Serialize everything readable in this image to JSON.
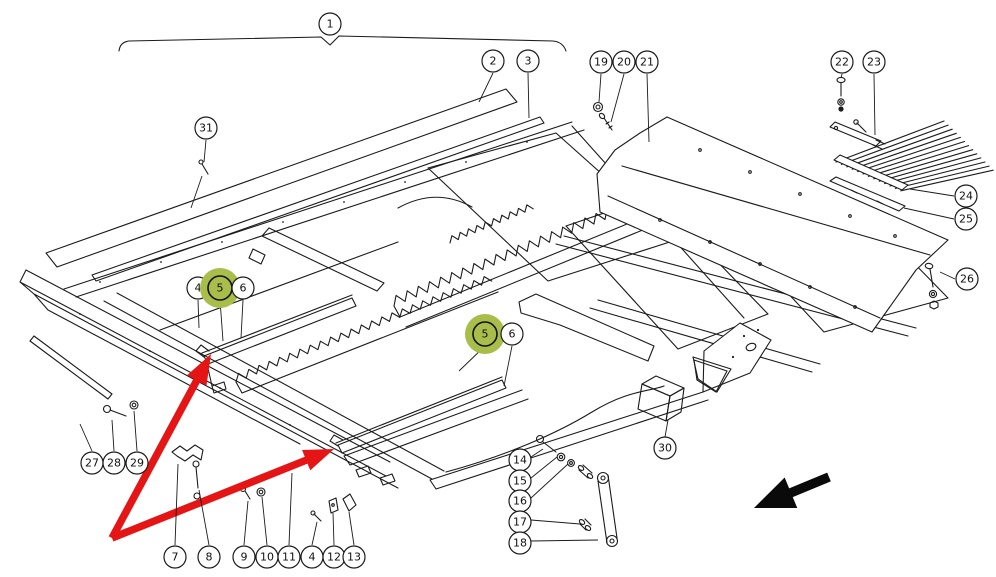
{
  "figure": {
    "title": "exploded-parts-diagram",
    "background_color": "#ffffff",
    "line_color": "#1b1b1b",
    "highlight_color": "#a9bd4a",
    "red_arrow_color": "#e51515",
    "black_arrow_color": "#0a0a0a",
    "callout_radius": 11,
    "highlight_halo_radius": 20
  },
  "assembly_bracket": {
    "label": "1",
    "x": 330,
    "y": 24
  },
  "callouts": [
    {
      "id": "1",
      "number": "1",
      "x": 330,
      "y": 24,
      "highlighted": false,
      "leaders": []
    },
    {
      "id": "2",
      "number": "2",
      "x": 493,
      "y": 61,
      "highlighted": false,
      "leaders": [
        [
          [
            493,
            73
          ],
          [
            479,
            102
          ]
        ]
      ]
    },
    {
      "id": "3",
      "number": "3",
      "x": 528,
      "y": 61,
      "highlighted": false,
      "leaders": [
        [
          [
            528,
            73
          ],
          [
            529,
            118
          ]
        ]
      ]
    },
    {
      "id": "31",
      "number": "31",
      "x": 206,
      "y": 128,
      "highlighted": false,
      "leaders": [
        [
          [
            206,
            140
          ],
          [
            204,
            162
          ]
        ],
        [
          [
            202,
            176
          ],
          [
            191,
            208
          ]
        ]
      ]
    },
    {
      "id": "19",
      "number": "19",
      "x": 601,
      "y": 62,
      "highlighted": false,
      "leaders": [
        [
          [
            601,
            74
          ],
          [
            599,
            102
          ]
        ]
      ]
    },
    {
      "id": "20",
      "number": "20",
      "x": 624,
      "y": 62,
      "highlighted": false,
      "leaders": [
        [
          [
            624,
            74
          ],
          [
            611,
            122
          ]
        ]
      ]
    },
    {
      "id": "21",
      "number": "21",
      "x": 647,
      "y": 62,
      "highlighted": false,
      "leaders": [
        [
          [
            647,
            74
          ],
          [
            649,
            142
          ]
        ]
      ]
    },
    {
      "id": "22",
      "number": "22",
      "x": 842,
      "y": 62,
      "highlighted": false,
      "leaders": [
        [
          [
            842,
            74
          ],
          [
            841,
            78
          ]
        ]
      ]
    },
    {
      "id": "23",
      "number": "23",
      "x": 874,
      "y": 62,
      "highlighted": false,
      "leaders": [
        [
          [
            874,
            74
          ],
          [
            875,
            135
          ]
        ]
      ]
    },
    {
      "id": "24",
      "number": "24",
      "x": 966,
      "y": 196,
      "highlighted": false,
      "leaders": [
        [
          [
            954,
            196
          ],
          [
            910,
            189
          ]
        ]
      ]
    },
    {
      "id": "25",
      "number": "25",
      "x": 966,
      "y": 219,
      "highlighted": false,
      "leaders": [
        [
          [
            954,
            219
          ],
          [
            904,
            208
          ]
        ]
      ]
    },
    {
      "id": "26",
      "number": "26",
      "x": 967,
      "y": 279,
      "highlighted": false,
      "leaders": [
        [
          [
            955,
            279
          ],
          [
            940,
            272
          ]
        ]
      ]
    },
    {
      "id": "4a",
      "number": "4",
      "x": 198,
      "y": 288,
      "highlighted": false,
      "leaders": [
        [
          [
            198,
            300
          ],
          [
            199,
            328
          ]
        ]
      ]
    },
    {
      "id": "5a",
      "number": "5",
      "x": 220,
      "y": 288,
      "highlighted": true,
      "leaders": [
        [
          [
            220,
            300
          ],
          [
            223,
            341
          ]
        ]
      ]
    },
    {
      "id": "6a",
      "number": "6",
      "x": 243,
      "y": 288,
      "highlighted": false,
      "leaders": [
        [
          [
            243,
            300
          ],
          [
            241,
            338
          ]
        ]
      ]
    },
    {
      "id": "5b",
      "number": "5",
      "x": 485,
      "y": 334,
      "highlighted": true,
      "leaders": [
        [
          [
            485,
            346
          ],
          [
            459,
            371
          ]
        ]
      ]
    },
    {
      "id": "6b",
      "number": "6",
      "x": 512,
      "y": 334,
      "highlighted": false,
      "leaders": [
        [
          [
            512,
            346
          ],
          [
            504,
            386
          ]
        ]
      ]
    },
    {
      "id": "27",
      "number": "27",
      "x": 92,
      "y": 463,
      "highlighted": false,
      "leaders": [
        [
          [
            92,
            451
          ],
          [
            80,
            424
          ]
        ]
      ]
    },
    {
      "id": "28",
      "number": "28",
      "x": 114,
      "y": 463,
      "highlighted": false,
      "leaders": [
        [
          [
            114,
            451
          ],
          [
            112,
            420
          ]
        ]
      ]
    },
    {
      "id": "29",
      "number": "29",
      "x": 137,
      "y": 463,
      "highlighted": false,
      "leaders": [
        [
          [
            137,
            451
          ],
          [
            134,
            411
          ]
        ]
      ]
    },
    {
      "id": "7",
      "number": "7",
      "x": 175,
      "y": 557,
      "highlighted": false,
      "leaders": [
        [
          [
            175,
            545
          ],
          [
            178,
            464
          ]
        ]
      ]
    },
    {
      "id": "8",
      "number": "8",
      "x": 209,
      "y": 557,
      "highlighted": false,
      "leaders": [
        [
          [
            209,
            545
          ],
          [
            199,
            490
          ]
        ]
      ]
    },
    {
      "id": "9",
      "number": "9",
      "x": 244,
      "y": 557,
      "highlighted": false,
      "leaders": [
        [
          [
            244,
            545
          ],
          [
            248,
            501
          ]
        ]
      ]
    },
    {
      "id": "10",
      "number": "10",
      "x": 267,
      "y": 557,
      "highlighted": false,
      "leaders": [
        [
          [
            267,
            545
          ],
          [
            262,
            497
          ]
        ]
      ]
    },
    {
      "id": "11",
      "number": "11",
      "x": 289,
      "y": 557,
      "highlighted": false,
      "leaders": [
        [
          [
            289,
            545
          ],
          [
            292,
            473
          ]
        ]
      ]
    },
    {
      "id": "4b",
      "number": "4",
      "x": 312,
      "y": 557,
      "highlighted": false,
      "leaders": [
        [
          [
            312,
            545
          ],
          [
            317,
            522
          ]
        ]
      ]
    },
    {
      "id": "12",
      "number": "12",
      "x": 334,
      "y": 557,
      "highlighted": false,
      "leaders": [
        [
          [
            334,
            545
          ],
          [
            333,
            513
          ]
        ]
      ]
    },
    {
      "id": "13",
      "number": "13",
      "x": 354,
      "y": 557,
      "highlighted": false,
      "leaders": [
        [
          [
            354,
            545
          ],
          [
            349,
            512
          ]
        ]
      ]
    },
    {
      "id": "14",
      "number": "14",
      "x": 520,
      "y": 460,
      "highlighted": false,
      "leaders": [
        [
          [
            531,
            457
          ],
          [
            543,
            449
          ]
        ]
      ]
    },
    {
      "id": "15",
      "number": "15",
      "x": 520,
      "y": 481,
      "highlighted": false,
      "leaders": [
        [
          [
            531,
            478
          ],
          [
            557,
            457
          ]
        ]
      ]
    },
    {
      "id": "16",
      "number": "16",
      "x": 520,
      "y": 501,
      "highlighted": false,
      "leaders": [
        [
          [
            531,
            498
          ],
          [
            568,
            464
          ]
        ]
      ]
    },
    {
      "id": "17",
      "number": "17",
      "x": 520,
      "y": 522,
      "highlighted": false,
      "leaders": [
        [
          [
            531,
            520
          ],
          [
            580,
            524
          ]
        ]
      ]
    },
    {
      "id": "18",
      "number": "18",
      "x": 520,
      "y": 543,
      "highlighted": false,
      "leaders": [
        [
          [
            531,
            541
          ],
          [
            598,
            540
          ]
        ]
      ]
    },
    {
      "id": "30",
      "number": "30",
      "x": 665,
      "y": 448,
      "highlighted": false,
      "leaders": [
        [
          [
            665,
            437
          ],
          [
            668,
            420
          ]
        ]
      ]
    }
  ],
  "red_arrows": [
    {
      "from": [
        112,
        538
      ],
      "to": [
        211,
        354
      ]
    },
    {
      "from": [
        112,
        538
      ],
      "to": [
        334,
        449
      ]
    }
  ],
  "black_arrow": {
    "from": [
      829,
      477
    ],
    "to": [
      754,
      508
    ]
  }
}
